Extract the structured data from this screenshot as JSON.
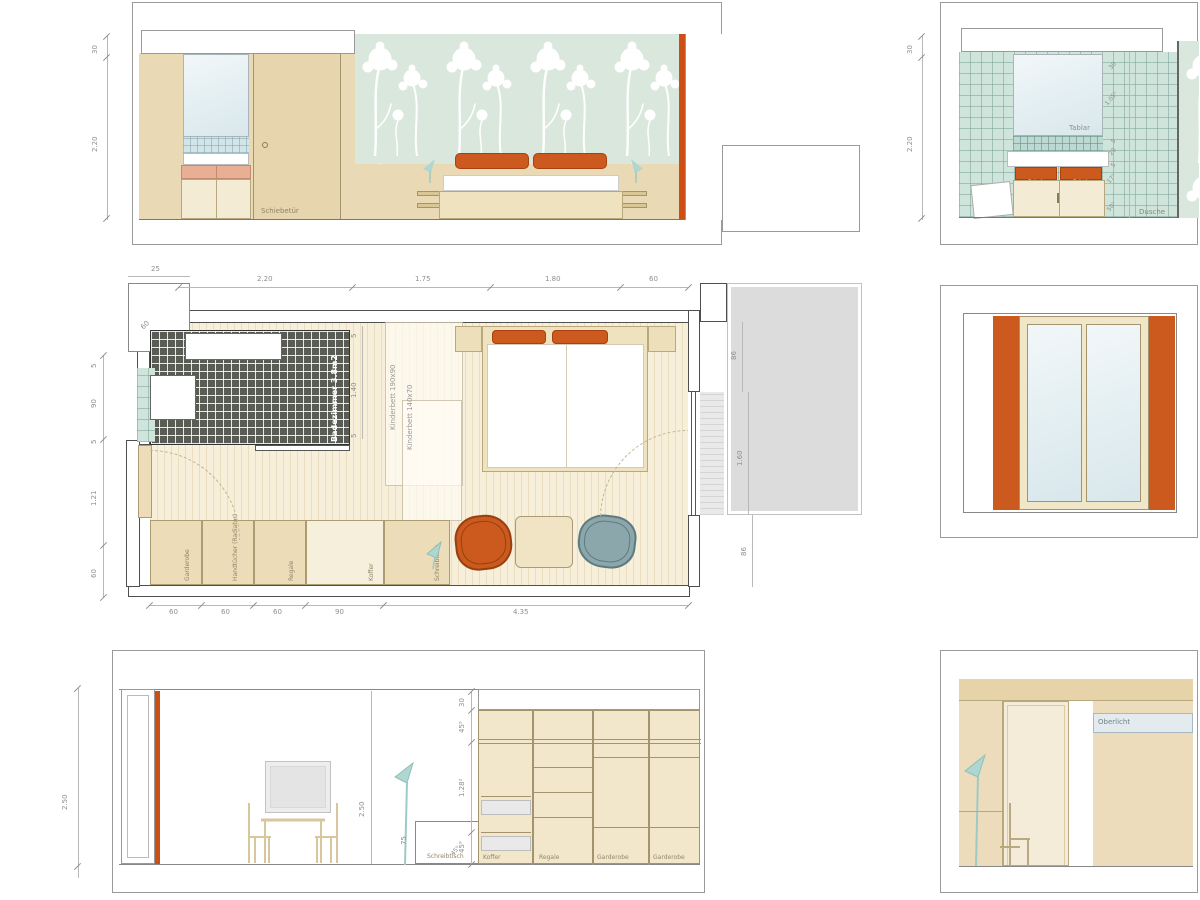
{
  "colors": {
    "accent_orange": "#cc5a1e",
    "curtain_orange": "#cc4f16",
    "wall_beige": "#ead9b5",
    "wallpaper_green": "#dae7dc",
    "tile_green": "#cfe4da",
    "dark_tile": "#585c54",
    "lamp_teal": "#aed7d2",
    "balcony_gray": "#dcdcdc",
    "chair_gray": "#8ca7ab"
  },
  "elevation_bed": {
    "dim_ceiling": "30",
    "dim_wall": "2.20",
    "sliding_door_label": "Schiebetür"
  },
  "elevation_bath": {
    "dim_ceiling": "30",
    "dim_wall": "2.20",
    "shelf_label": "Tablar",
    "shower_label": "Dusche",
    "drawer_left": "Schub",
    "drawer_right": "Schub",
    "right_dims": [
      "30",
      "1.05⁵",
      "5",
      "20",
      "5",
      "17⁵",
      "50⁵"
    ]
  },
  "floor_plan": {
    "top_dims": [
      "2.20",
      "1.75",
      "1.80",
      "60"
    ],
    "niche_dim": "25",
    "niche_diag_dim": "60",
    "left_dims": [
      "5",
      "90",
      "5",
      "1.21",
      "60"
    ],
    "bottom_dims": [
      "60",
      "60",
      "60",
      "90",
      "4.35"
    ],
    "right_dims": [
      "86",
      "1.60",
      "86"
    ],
    "bath_dims": [
      "5",
      "1.40",
      "5"
    ],
    "bathroom_label": "Badezimmer 3.8m2",
    "bed_label_1": "Kinderbett 190x90",
    "bed_label_2": "Kinderbett 140x70",
    "furniture_labels": [
      "Garderobe",
      "Handtücher (Radiator)",
      "Regale",
      "Koffer",
      "Schreibtisch"
    ]
  },
  "elevation_room": {
    "dim_left": "2.50",
    "dim_mid": "2.50",
    "desk_label": "Schreibtisch",
    "desk_height_dim": "75",
    "desk_diag_dim": "45⁹",
    "right_dims": [
      "30",
      "45⁹",
      "1.28²",
      "45⁹"
    ],
    "wardrobe_labels": [
      "Koffer",
      "Regale",
      "Garderobe",
      "Garderobe"
    ]
  },
  "elevation_detail": {
    "skylight_label": "Oberlicht"
  }
}
